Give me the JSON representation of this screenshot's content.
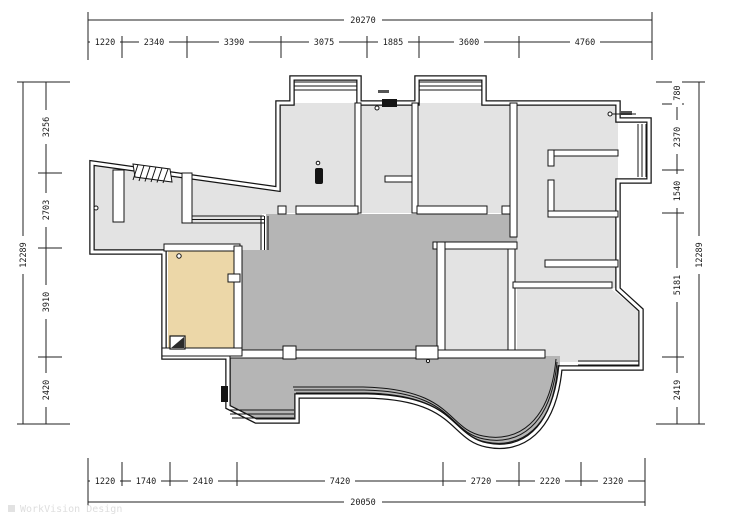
{
  "watermark": "WorkVision Design",
  "colors": {
    "room_light": "#e3e3e3",
    "room_mid": "#b5b5b5",
    "kitchen_tan": "#ecd7a8",
    "wall": "#141414",
    "dimension": "#222222"
  },
  "dimensions": {
    "top": {
      "total": "20270",
      "segments": [
        "1220",
        "2340",
        "3390",
        "3075",
        "1885",
        "3600",
        "4760"
      ]
    },
    "bottom": {
      "total": "20050",
      "segments": [
        "1220",
        "1740",
        "2410",
        "7420",
        "2720",
        "2220",
        "2320"
      ]
    },
    "left": {
      "total": "12289",
      "segments": [
        "3256",
        "2703",
        "3910",
        "2420"
      ]
    },
    "right": {
      "total": "12289",
      "segments": [
        "780",
        "2370",
        "1540",
        "5181",
        "2419"
      ]
    }
  }
}
